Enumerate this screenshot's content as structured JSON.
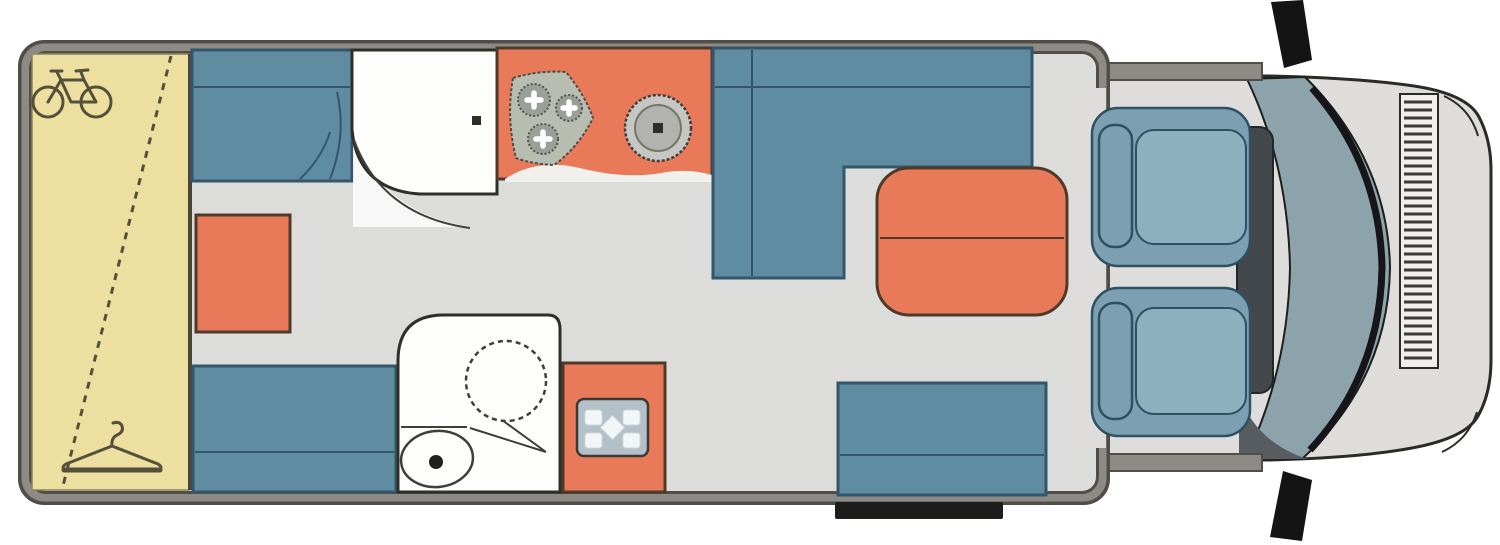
{
  "diagram": {
    "type": "motorhome-floorplan-top-view",
    "title": "Motorhome floor plan",
    "colors": {
      "wall_edge": "#514e47",
      "wall_gray": "#8e8b87",
      "floor_gray": "#dcdcda",
      "garage_yellow": "#ecdfa0",
      "garage_border": "#8a845f",
      "icon_olive": "#55503a",
      "furniture_blue": "#5f8ca1",
      "furniture_blue_border": "#33566a",
      "accent_orange": "#e87a59",
      "orange_border": "#4f3a2a",
      "fixture_white": "#fdfdfc",
      "line_dark": "#2f2f2a",
      "step_black": "#1d1d1b",
      "cab_body": "#dedddb",
      "windshield_teal": "#8ca3ab",
      "dark_metal": "#141414",
      "cab_seat_blue": "#7c9fb2",
      "cab_seat_inner": "#8db0bf",
      "cab_seat_border": "#2e5063",
      "panel_gray": "#b3c0c7",
      "hob_green": "#b7bdb0"
    },
    "zones": {
      "body_shell": {
        "label": "Vehicle body shell (outer wall)"
      },
      "floor": {
        "label": "Interior floor"
      },
      "garage": {
        "label": "Rear garage storage with drop-down bed"
      },
      "bike_icon": {
        "label": "Bicycle storage icon"
      },
      "hanger_icon": {
        "label": "Wardrobe clothes-hanger icon"
      },
      "drop_bed_line": {
        "label": "Drop-down bed dashed outline"
      },
      "single_bed_top": {
        "label": "Rear single bed (top side)"
      },
      "single_bed_bottom": {
        "label": "Rear single bed (bottom side)"
      },
      "cabinet": {
        "label": "Storage cabinet / chest"
      },
      "shower": {
        "label": "Shower cubicle with door"
      },
      "shower_door": {
        "label": "Shower door swing arc"
      },
      "kitchen": {
        "label": "Kitchen counter"
      },
      "hob": {
        "label": "Three-burner gas hob"
      },
      "sink": {
        "label": "Round kitchen sink"
      },
      "dinette": {
        "label": "L-shaped dinette sofa"
      },
      "table": {
        "label": "Dining table with folding extension"
      },
      "bench_seat": {
        "label": "Forward-facing travel bench seat"
      },
      "entry_step": {
        "label": "Entrance door step"
      },
      "washroom": {
        "label": "Washroom"
      },
      "washbasin": {
        "label": "Swivel washbasin (dashed)"
      },
      "toilet": {
        "label": "Toilet"
      },
      "wet_module": {
        "label": "Shower tray cabinet"
      },
      "drain_grid": {
        "label": "Shower drain grid"
      },
      "cab": {
        "label": "Driver cab"
      },
      "windshield": {
        "label": "Windscreen"
      },
      "dashboard": {
        "label": "Dashboard console"
      },
      "grille": {
        "label": "Front grille"
      },
      "mirror_top": {
        "label": "Wing mirror (left)"
      },
      "mirror_bottom": {
        "label": "Wing mirror (right)"
      },
      "driver_seat": {
        "label": "Cab captain seat (driver)"
      },
      "passenger_seat": {
        "label": "Cab captain seat (passenger)"
      }
    }
  }
}
